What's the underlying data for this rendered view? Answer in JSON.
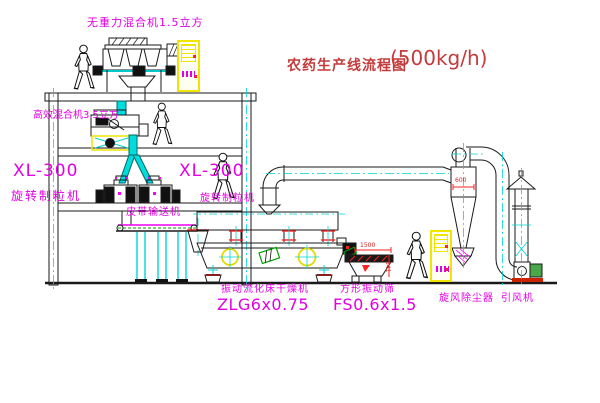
{
  "diagram": {
    "title": "农药生产线流程图",
    "capacity": "(500kg/h)"
  },
  "labels": {
    "top_mixer": "无重力混合机1.5立方",
    "mid_mixer": "高效混合机3.5立方",
    "granulator_left_model": "XL-300",
    "granulator_left_name": "旋转制粒机",
    "granulator_right_model": "XL-300",
    "granulator_right_name": "旋转制粒机",
    "belt_conveyor": "皮带输送机",
    "dryer_name": "振动流化床干燥机",
    "dryer_model": "ZLG6x0.75",
    "sieve_name": "方形振动筛",
    "sieve_model": "FS0.6x1.5",
    "cyclone": "旋风除尘器",
    "fan": "引风机"
  },
  "dimensions": {
    "cyclone_inlet": "600",
    "sieve_length": "1500",
    "sieve_height": "341"
  },
  "colors": {
    "label_magenta": "#e400e4",
    "title_red": "#c43b3b",
    "line_black": "#1a1a1a",
    "equipment_yellow": "#f0e400",
    "centerline_cyan": "#00d4d4",
    "accent_green": "#00a000",
    "accent_red": "#ff2020"
  }
}
